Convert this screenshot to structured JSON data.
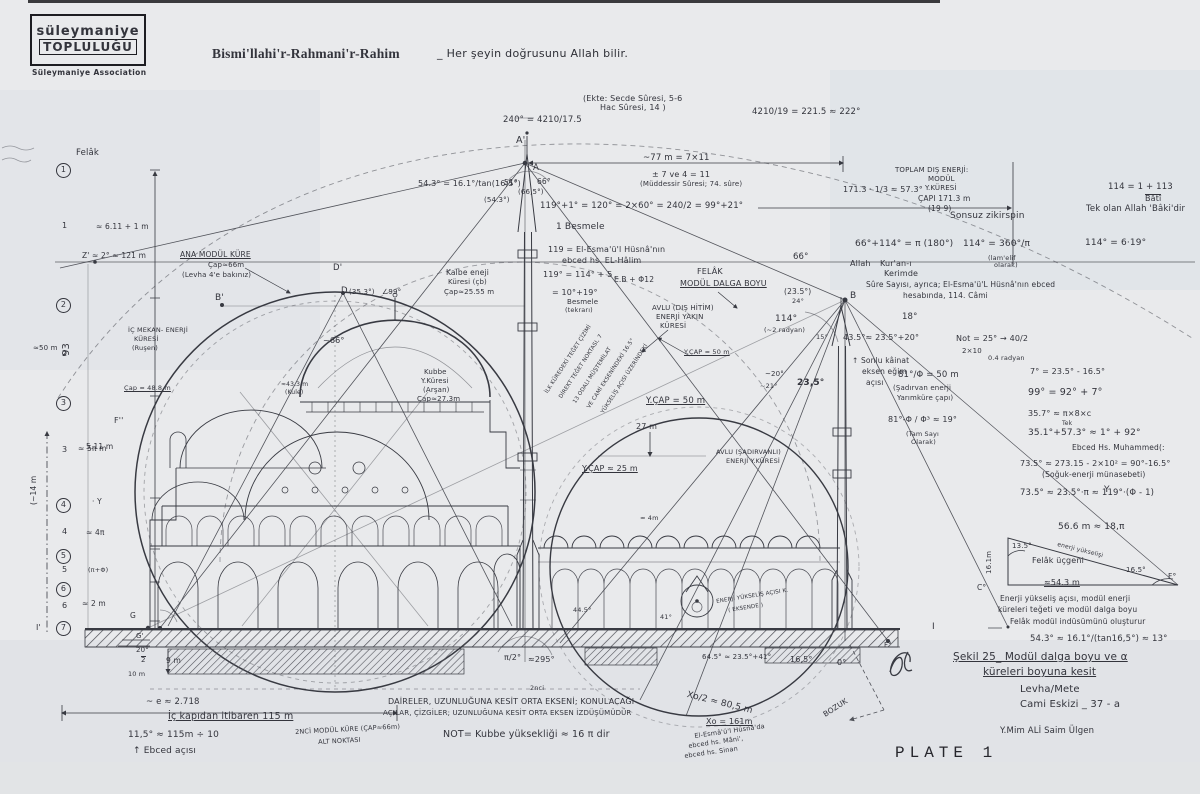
{
  "colors": {
    "paper": "#e9eaec",
    "ink": "#33343c",
    "shade": "#d9dfe4"
  },
  "header": {
    "logo_line1": "süleymaniye",
    "logo_line2": "TOPLULUĞU",
    "logo_sub": "Süleymaniye Association",
    "bismillah": "Bismi'llahi'r-Rahmani'r-Rahim",
    "motto": "_ Her şeyin doğrusunu Allah bilir."
  },
  "footer": {
    "plate": "PLATE 1"
  },
  "annotations": [
    {
      "t": "(Ekte: Secde Sûresi, 5-6",
      "x": 583,
      "y": 95,
      "fs": 8
    },
    {
      "t": "Hac Sûresi, 14 )",
      "x": 600,
      "y": 104,
      "fs": 8
    },
    {
      "t": "240° = 4210/17.5",
      "x": 503,
      "y": 116,
      "fs": 8.5
    },
    {
      "t": "4210/19 = 221.5 ≈ 222°",
      "x": 752,
      "y": 108,
      "fs": 8.5
    },
    {
      "t": "A'",
      "x": 516,
      "y": 136,
      "fs": 9.5
    },
    {
      "t": "A",
      "x": 533,
      "y": 164,
      "fs": 8.5
    },
    {
      "t": "~77 m = 7×11",
      "x": 643,
      "y": 154,
      "fs": 8.5
    },
    {
      "t": "± 7 ve 4 = 11",
      "x": 652,
      "y": 171,
      "fs": 8
    },
    {
      "t": "(Müddessir Sûresi; 74. sûre)",
      "x": 640,
      "y": 181,
      "fs": 7
    },
    {
      "t": "54.3° = 16.1°/tan(16,5°)",
      "x": 418,
      "y": 180,
      "fs": 8
    },
    {
      "t": "51°",
      "x": 504,
      "y": 179,
      "fs": 7.5
    },
    {
      "t": "66°",
      "x": 537,
      "y": 178,
      "fs": 7.5
    },
    {
      "t": "(66,5°)",
      "x": 518,
      "y": 189,
      "fs": 7
    },
    {
      "t": "(54.3°)",
      "x": 484,
      "y": 197,
      "fs": 7
    },
    {
      "t": "119°+1° = 120° = 2×60° = 240/2 = 99°+21°",
      "x": 540,
      "y": 202,
      "fs": 8.5
    },
    {
      "t": "1 Besmele",
      "x": 556,
      "y": 223,
      "fs": 9
    },
    {
      "t": "119 = El-Esma'ü'l Hüsnâ'nın",
      "x": 548,
      "y": 246,
      "fs": 8
    },
    {
      "t": "ebced hs. EL-Hâlim",
      "x": 562,
      "y": 257,
      "fs": 8
    },
    {
      "t": "119° = 114° + 5",
      "x": 543,
      "y": 271,
      "fs": 8
    },
    {
      "t": "E.B + Φ12",
      "x": 614,
      "y": 276,
      "fs": 7.5
    },
    {
      "t": "= 10°+19°",
      "x": 552,
      "y": 289,
      "fs": 8
    },
    {
      "t": "Besmele",
      "x": 567,
      "y": 299,
      "fs": 7
    },
    {
      "t": "(tekrarı)",
      "x": 565,
      "y": 307,
      "fs": 6.5
    },
    {
      "t": "TOPLAM DIŞ ENERJİ:",
      "x": 895,
      "y": 167,
      "fs": 7
    },
    {
      "t": "MODÜL",
      "x": 928,
      "y": 176,
      "fs": 7
    },
    {
      "t": "Y.KÜRESİ",
      "x": 925,
      "y": 185,
      "fs": 7
    },
    {
      "t": "ÇAPI 171.3 m",
      "x": 918,
      "y": 195,
      "fs": 7.5
    },
    {
      "t": "(19·9)",
      "x": 928,
      "y": 205,
      "fs": 7.5
    },
    {
      "t": "171.3 · 1/3 ≈ 57.3°",
      "x": 843,
      "y": 186,
      "fs": 8
    },
    {
      "t": "114 = 1 + 113",
      "x": 1108,
      "y": 183,
      "fs": 8.5
    },
    {
      "t": "Bâtî",
      "x": 1145,
      "y": 194,
      "fs": 8,
      "ov": 1
    },
    {
      "t": "Tek olan Allah 'Bâki'dir",
      "x": 1086,
      "y": 205,
      "fs": 8.5
    },
    {
      "t": "Sonsuz zikirspin",
      "x": 950,
      "y": 212,
      "fs": 9
    },
    {
      "t": "66°+114° = π (180°)",
      "x": 855,
      "y": 240,
      "fs": 9
    },
    {
      "t": "114° = 360°/π",
      "x": 963,
      "y": 240,
      "fs": 9
    },
    {
      "t": "(lam'elif",
      "x": 988,
      "y": 255,
      "fs": 6.5
    },
    {
      "t": "olarak)",
      "x": 994,
      "y": 262,
      "fs": 6.5
    },
    {
      "t": "114° = 6·19°",
      "x": 1085,
      "y": 239,
      "fs": 9
    },
    {
      "t": "Allah",
      "x": 850,
      "y": 260,
      "fs": 8
    },
    {
      "t": "Kur'an-ı",
      "x": 880,
      "y": 260,
      "fs": 8
    },
    {
      "t": "Kerimde",
      "x": 884,
      "y": 270,
      "fs": 8
    },
    {
      "t": "Sûre Sayısı, ayrıca; El-Esma'ü'L Hüsnâ'nın ebced",
      "x": 866,
      "y": 281,
      "fs": 7.5
    },
    {
      "t": "hesabında, 114. Câmi",
      "x": 903,
      "y": 292,
      "fs": 7.5
    },
    {
      "t": "66°",
      "x": 793,
      "y": 253,
      "fs": 8.5
    },
    {
      "t": "18°",
      "x": 902,
      "y": 313,
      "fs": 8.5
    },
    {
      "t": "43.5°≈ 23.5°+20°",
      "x": 843,
      "y": 334,
      "fs": 8
    },
    {
      "t": "Not = 25° → 40/2",
      "x": 956,
      "y": 335,
      "fs": 8
    },
    {
      "t": "2×10",
      "x": 962,
      "y": 348,
      "fs": 7
    },
    {
      "t": "0.4 radyan",
      "x": 988,
      "y": 355,
      "fs": 6.5
    },
    {
      "t": "↑ Sonlu kâinat",
      "x": 852,
      "y": 357,
      "fs": 7.5
    },
    {
      "t": "eksen eğim",
      "x": 862,
      "y": 368,
      "fs": 7.5
    },
    {
      "t": "açısı",
      "x": 866,
      "y": 379,
      "fs": 7.5
    },
    {
      "t": "81°/Φ = 50 m",
      "x": 898,
      "y": 371,
      "fs": 8.5
    },
    {
      "t": "(Şadırvan enerji",
      "x": 893,
      "y": 385,
      "fs": 7
    },
    {
      "t": "Yarımküre çapı)",
      "x": 897,
      "y": 395,
      "fs": 7
    },
    {
      "t": "81°-Φ / Φ³ ≈ 19°",
      "x": 888,
      "y": 416,
      "fs": 8
    },
    {
      "t": "(Tam Sayı",
      "x": 906,
      "y": 431,
      "fs": 6.5
    },
    {
      "t": "Olarak)",
      "x": 911,
      "y": 439,
      "fs": 6.5
    },
    {
      "t": "7° = 23.5° - 16.5°",
      "x": 1030,
      "y": 368,
      "fs": 8
    },
    {
      "t": "99° = 92° + 7°",
      "x": 1028,
      "y": 388,
      "fs": 9.5
    },
    {
      "t": "35.7° ≈ π×8×c",
      "x": 1028,
      "y": 410,
      "fs": 8
    },
    {
      "t": "Tek",
      "x": 1062,
      "y": 421,
      "fs": 6
    },
    {
      "t": "35.1°+57.3° ≈ 1° + 92°",
      "x": 1028,
      "y": 429,
      "fs": 9
    },
    {
      "t": "Ebced Hs. Muhammed(:",
      "x": 1072,
      "y": 444,
      "fs": 7.5
    },
    {
      "t": "73.5° ≈ 273.15 - 2×10² = 90°-16.5°",
      "x": 1020,
      "y": 460,
      "fs": 8
    },
    {
      "t": "(Soğuk-enerji münasebeti)",
      "x": 1042,
      "y": 471,
      "fs": 7.5
    },
    {
      "t": "73.5° ≈ 23.5°·π ≈ 119°·(Φ - 1)",
      "x": 1020,
      "y": 489,
      "fs": 8.5
    },
    {
      "t": "56.6 m ≈ 18,π",
      "x": 1058,
      "y": 523,
      "fs": 9
    },
    {
      "t": "13.5°",
      "x": 1012,
      "y": 543,
      "fs": 7
    },
    {
      "t": "16.1m",
      "x": 986,
      "y": 574,
      "fs": 7,
      "r": -90
    },
    {
      "t": "Felâk üçgeni",
      "x": 1032,
      "y": 557,
      "fs": 8
    },
    {
      "t": "enerji yükselişi",
      "x": 1058,
      "y": 542,
      "fs": 6,
      "r": 14
    },
    {
      "t": "16.5°",
      "x": 1126,
      "y": 567,
      "fs": 7
    },
    {
      "t": "≈54.3 m",
      "x": 1044,
      "y": 579,
      "fs": 8,
      "u": 1
    },
    {
      "t": "F°",
      "x": 1168,
      "y": 573,
      "fs": 7.5
    },
    {
      "t": "C°",
      "x": 977,
      "y": 584,
      "fs": 7.5
    },
    {
      "t": "Enerji yükseliş açısı, modül enerji",
      "x": 1000,
      "y": 595,
      "fs": 7.5
    },
    {
      "t": "küreleri teğeti ve modül dalga boyu",
      "x": 998,
      "y": 606,
      "fs": 7.5
    },
    {
      "t": "Felâk modül indüsümünü oluşturur",
      "x": 1010,
      "y": 618,
      "fs": 7.5
    },
    {
      "t": "54.3° ≈ 16.1°/(tan16,5°) ≈ 13°",
      "x": 1030,
      "y": 635,
      "fs": 8.5
    },
    {
      "t": "I",
      "x": 932,
      "y": 623,
      "fs": 9
    },
    {
      "t": "F°",
      "x": 884,
      "y": 642,
      "fs": 7
    },
    {
      "t": "Şekil 25_ Modül dalga boyu ve α",
      "x": 953,
      "y": 652,
      "fs": 10.5,
      "u": 1
    },
    {
      "t": "küreleri boyuna kesit",
      "x": 983,
      "y": 667,
      "fs": 10.5,
      "u": 1
    },
    {
      "t": "Levha/Mete",
      "x": 1020,
      "y": 685,
      "fs": 10
    },
    {
      "t": "Cami Eskizi _ 37 - a",
      "x": 1020,
      "y": 700,
      "fs": 10
    },
    {
      "t": "Y.Mim ALİ Saim Ülgen",
      "x": 1000,
      "y": 727,
      "fs": 8.5
    },
    {
      "t": "2nci",
      "x": 530,
      "y": 685,
      "fs": 6.5
    },
    {
      "t": "DAİRELER, UZUNLUĞUNA KESİT ORTA EKSENİ; KONULACAĞI",
      "x": 388,
      "y": 698,
      "fs": 8
    },
    {
      "t": "AÇILAR, ÇİZGİLER; UZUNLUĞUNA KESİT ORTA EKSEN İZDÜŞÜMÜDÜR",
      "x": 383,
      "y": 710,
      "fs": 7
    },
    {
      "t": "NOT= Kubbe yüksekliği ≈ 16 π dir",
      "x": 443,
      "y": 730,
      "fs": 9.5
    },
    {
      "t": "2NCİ MODÜL KÜRE (ÇAP≈66m)",
      "x": 295,
      "y": 729,
      "fs": 6.5,
      "r": -3
    },
    {
      "t": "ALT NOKTASI",
      "x": 318,
      "y": 739,
      "fs": 6.5,
      "r": -3
    },
    {
      "t": "20°",
      "x": 136,
      "y": 647,
      "fs": 7
    },
    {
      "t": "2",
      "x": 141,
      "y": 656,
      "fs": 7,
      "ov": 1
    },
    {
      "t": "9 m",
      "x": 166,
      "y": 657,
      "fs": 7.5
    },
    {
      "t": "10 m",
      "x": 128,
      "y": 671,
      "fs": 6.5
    },
    {
      "t": "~ e ≈ 2.718",
      "x": 146,
      "y": 698,
      "fs": 8.5
    },
    {
      "t": "İç kapıdan itibaren 115 m",
      "x": 168,
      "y": 712,
      "fs": 9.5,
      "u": 1
    },
    {
      "t": "11,5° ≈ 115m ÷ 10",
      "x": 128,
      "y": 731,
      "fs": 9
    },
    {
      "t": "↑ Ebced açısı",
      "x": 133,
      "y": 747,
      "fs": 9
    },
    {
      "t": "π/2°",
      "x": 504,
      "y": 654,
      "fs": 8
    },
    {
      "t": "≈295°",
      "x": 528,
      "y": 656,
      "fs": 8
    },
    {
      "t": "44.5°",
      "x": 573,
      "y": 607,
      "fs": 6.5
    },
    {
      "t": "41°",
      "x": 660,
      "y": 614,
      "fs": 6.5
    },
    {
      "t": "≈ 4m",
      "x": 640,
      "y": 515,
      "fs": 6.5
    },
    {
      "t": "64.5° ≈ 23.5°+41°",
      "x": 702,
      "y": 654,
      "fs": 7
    },
    {
      "t": "16,5°",
      "x": 790,
      "y": 656,
      "fs": 8
    },
    {
      "t": "0°",
      "x": 837,
      "y": 659,
      "fs": 8
    },
    {
      "t": "Xo/2 ≈ 80,5 m",
      "x": 688,
      "y": 691,
      "fs": 9,
      "r": 14
    },
    {
      "t": "Xo = 161m",
      "x": 706,
      "y": 718,
      "fs": 8,
      "u": 1
    },
    {
      "t": "El-Esmâ'ü'l Hüsnâ'da",
      "x": 694,
      "y": 733,
      "fs": 6.5,
      "r": -8
    },
    {
      "t": "ebced hs. Mâni',",
      "x": 688,
      "y": 743,
      "fs": 6.5,
      "r": -8
    },
    {
      "t": "ebced hs. Sinan",
      "x": 684,
      "y": 753,
      "fs": 6.5,
      "r": -8
    },
    {
      "t": "BOZUK",
      "x": 822,
      "y": 712,
      "fs": 7.5,
      "r": -33
    },
    {
      "t": "ENERJİ YÜKSELİŞ AÇISI K.",
      "x": 716,
      "y": 600,
      "fs": 5.5,
      "r": -9
    },
    {
      "t": "( EKSENDE )",
      "x": 728,
      "y": 609,
      "fs": 5.5,
      "r": -9
    },
    {
      "t": "AVLU (ŞADIRVANLI)",
      "x": 716,
      "y": 449,
      "fs": 6.5
    },
    {
      "t": "ENERJİ Y.KÜRESİ",
      "x": 726,
      "y": 458,
      "fs": 6.5
    },
    {
      "t": "Y.ÇAP ≈ 25 m",
      "x": 582,
      "y": 465,
      "fs": 8,
      "u": 1
    },
    {
      "t": "27 m",
      "x": 636,
      "y": 423,
      "fs": 8
    },
    {
      "t": "Y.ÇAP = 50 m",
      "x": 646,
      "y": 397,
      "fs": 8.5,
      "u": 1
    },
    {
      "t": "Y.ÇAP ≈ 50 m",
      "x": 684,
      "y": 349,
      "fs": 6.5,
      "u": 1
    },
    {
      "t": "AVLU (DIŞ HİTİM)",
      "x": 652,
      "y": 305,
      "fs": 7
    },
    {
      "t": "ENERJİ YAKIN",
      "x": 656,
      "y": 314,
      "fs": 7
    },
    {
      "t": "KÜRESİ",
      "x": 660,
      "y": 323,
      "fs": 7
    },
    {
      "t": "114°",
      "x": 775,
      "y": 315,
      "fs": 9
    },
    {
      "t": "(~2 radyan)",
      "x": 764,
      "y": 327,
      "fs": 6.5
    },
    {
      "t": "~20°",
      "x": 765,
      "y": 371,
      "fs": 7
    },
    {
      "t": "~21°",
      "x": 760,
      "y": 383,
      "fs": 6.5
    },
    {
      "t": "23,5°",
      "x": 797,
      "y": 379,
      "fs": 9,
      "b": 1
    },
    {
      "t": "15°",
      "x": 816,
      "y": 334,
      "fs": 6.5
    },
    {
      "t": "(23.5°)",
      "x": 784,
      "y": 288,
      "fs": 7.5
    },
    {
      "t": "24°",
      "x": 792,
      "y": 298,
      "fs": 6.5
    },
    {
      "t": "FELÂK",
      "x": 697,
      "y": 268,
      "fs": 8
    },
    {
      "t": "MODÜL DALGA BOYU",
      "x": 680,
      "y": 280,
      "fs": 8,
      "u": 1
    },
    {
      "t": "B",
      "x": 850,
      "y": 292,
      "fs": 9
    },
    {
      "t": "İLK KÜREDEKİ TEĞET ÇİZİMİ",
      "x": 545,
      "y": 392,
      "fs": 5.5,
      "r": -57
    },
    {
      "t": "DİREKT TEĞET NOKTASI, 7",
      "x": 559,
      "y": 397,
      "fs": 5.5,
      "r": -57
    },
    {
      "t": "13 ODALI MÜŞTEMİLAT",
      "x": 573,
      "y": 402,
      "fs": 5.5,
      "r": -57
    },
    {
      "t": "VE CAMİ EKSENİNDEKİ 16.5°",
      "x": 587,
      "y": 407,
      "fs": 5.5,
      "r": -57
    },
    {
      "t": "YÜKSELİŞ AÇISI ÜZERİNDEKİ",
      "x": 601,
      "y": 412,
      "fs": 5.5,
      "r": -57
    },
    {
      "t": "ANA MODÜL KÜRE",
      "x": 180,
      "y": 251,
      "fs": 7.5,
      "u": 1
    },
    {
      "t": "Çap≈66m",
      "x": 208,
      "y": 262,
      "fs": 7
    },
    {
      "t": "(Levha 4'e bakınız)",
      "x": 182,
      "y": 272,
      "fs": 7
    },
    {
      "t": "B'",
      "x": 215,
      "y": 294,
      "fs": 9
    },
    {
      "t": "D'",
      "x": 333,
      "y": 264,
      "fs": 8.5
    },
    {
      "t": "D",
      "x": 341,
      "y": 287,
      "fs": 8.5
    },
    {
      "t": "(35.3°)",
      "x": 349,
      "y": 289,
      "fs": 7
    },
    {
      "t": "∠99°",
      "x": 382,
      "y": 289,
      "fs": 7
    },
    {
      "t": "~66°",
      "x": 323,
      "y": 337,
      "fs": 8
    },
    {
      "t": "İÇ MEKAN- ENERJİ",
      "x": 128,
      "y": 327,
      "fs": 6.5
    },
    {
      "t": "KÜRESİ",
      "x": 134,
      "y": 336,
      "fs": 6.5
    },
    {
      "t": "(Ruşen)",
      "x": 132,
      "y": 345,
      "fs": 6.5
    },
    {
      "t": "Çap ≈ 48.8 m",
      "x": 124,
      "y": 385,
      "fs": 6.5,
      "u": 1
    },
    {
      "t": "≈43.3 m",
      "x": 281,
      "y": 382,
      "fs": 6
    },
    {
      "t": "(Kule)",
      "x": 285,
      "y": 390,
      "fs": 6
    },
    {
      "t": "Kubbe",
      "x": 424,
      "y": 369,
      "fs": 7
    },
    {
      "t": "Y.Küresi",
      "x": 421,
      "y": 378,
      "fs": 7
    },
    {
      "t": "(Arşan)",
      "x": 423,
      "y": 387,
      "fs": 7
    },
    {
      "t": "Çap≈27.3m",
      "x": 417,
      "y": 396,
      "fs": 7
    },
    {
      "t": "Kalbe eneji",
      "x": 446,
      "y": 269,
      "fs": 7.5
    },
    {
      "t": "Küresi (çb)",
      "x": 448,
      "y": 279,
      "fs": 7
    },
    {
      "t": "Çap≈25.55 m",
      "x": 444,
      "y": 289,
      "fs": 7
    },
    {
      "t": "Z' ≈ 2° ≈ 121 m",
      "x": 82,
      "y": 252,
      "fs": 7.5
    },
    {
      "t": "≈ 6.11 + 1 m",
      "x": 96,
      "y": 223,
      "fs": 7.5
    },
    {
      "t": "≈50 m",
      "x": 33,
      "y": 345,
      "fs": 7
    },
    {
      "t": "5.11 m",
      "x": 86,
      "y": 443,
      "fs": 7.5
    },
    {
      "t": "(~14 m",
      "x": 30,
      "y": 505,
      "fs": 7.5,
      "r": -90
    },
    {
      "t": "93",
      "x": 62,
      "y": 356,
      "fs": 10,
      "r": -90
    },
    {
      "t": "Felâk",
      "x": 76,
      "y": 149,
      "fs": 8.5
    },
    {
      "t": "I'",
      "x": 36,
      "y": 624,
      "fs": 8
    },
    {
      "t": "G",
      "x": 130,
      "y": 612,
      "fs": 7.5
    },
    {
      "t": "G'",
      "x": 136,
      "y": 633,
      "fs": 7
    },
    {
      "t": "F''",
      "x": 114,
      "y": 417,
      "fs": 8
    },
    {
      "t": "Y",
      "x": 1104,
      "y": 486,
      "fs": 9
    },
    {
      "t": "1",
      "x": 56,
      "y": 163,
      "fs": 8,
      "c": 1,
      "n": "margin-scale-mark"
    },
    {
      "t": "2",
      "x": 56,
      "y": 298,
      "fs": 8,
      "c": 1,
      "n": "margin-scale-mark"
    },
    {
      "t": "3",
      "x": 56,
      "y": 396,
      "fs": 8,
      "c": 1,
      "n": "margin-scale-mark"
    },
    {
      "t": "4",
      "x": 56,
      "y": 498,
      "fs": 8,
      "c": 1,
      "n": "margin-scale-mark"
    },
    {
      "t": "5",
      "x": 56,
      "y": 549,
      "fs": 8,
      "c": 1,
      "n": "margin-scale-mark"
    },
    {
      "t": "6",
      "x": 56,
      "y": 582,
      "fs": 8,
      "c": 1,
      "n": "margin-scale-mark"
    },
    {
      "t": "7",
      "x": 56,
      "y": 621,
      "fs": 8,
      "c": 1,
      "n": "margin-scale-mark"
    },
    {
      "t": "1",
      "x": 62,
      "y": 222,
      "fs": 8,
      "n": "margin-interval"
    },
    {
      "t": "2",
      "x": 62,
      "y": 350,
      "fs": 8,
      "n": "margin-interval"
    },
    {
      "t": "3",
      "x": 62,
      "y": 446,
      "fs": 8,
      "n": "margin-interval"
    },
    {
      "t": "4",
      "x": 62,
      "y": 528,
      "fs": 8,
      "n": "margin-interval"
    },
    {
      "t": "5",
      "x": 62,
      "y": 566,
      "fs": 8,
      "n": "margin-interval"
    },
    {
      "t": "6",
      "x": 62,
      "y": 602,
      "fs": 8,
      "n": "margin-interval"
    },
    {
      "t": "≈ 5π m",
      "x": 78,
      "y": 445,
      "fs": 7.5
    },
    {
      "t": "· Y",
      "x": 92,
      "y": 498,
      "fs": 7.5
    },
    {
      "t": "≈ 4π",
      "x": 86,
      "y": 529,
      "fs": 7.5
    },
    {
      "t": "(π+Φ)",
      "x": 88,
      "y": 567,
      "fs": 6.5
    },
    {
      "t": "≈ 2 m",
      "x": 82,
      "y": 600,
      "fs": 7.5
    }
  ]
}
